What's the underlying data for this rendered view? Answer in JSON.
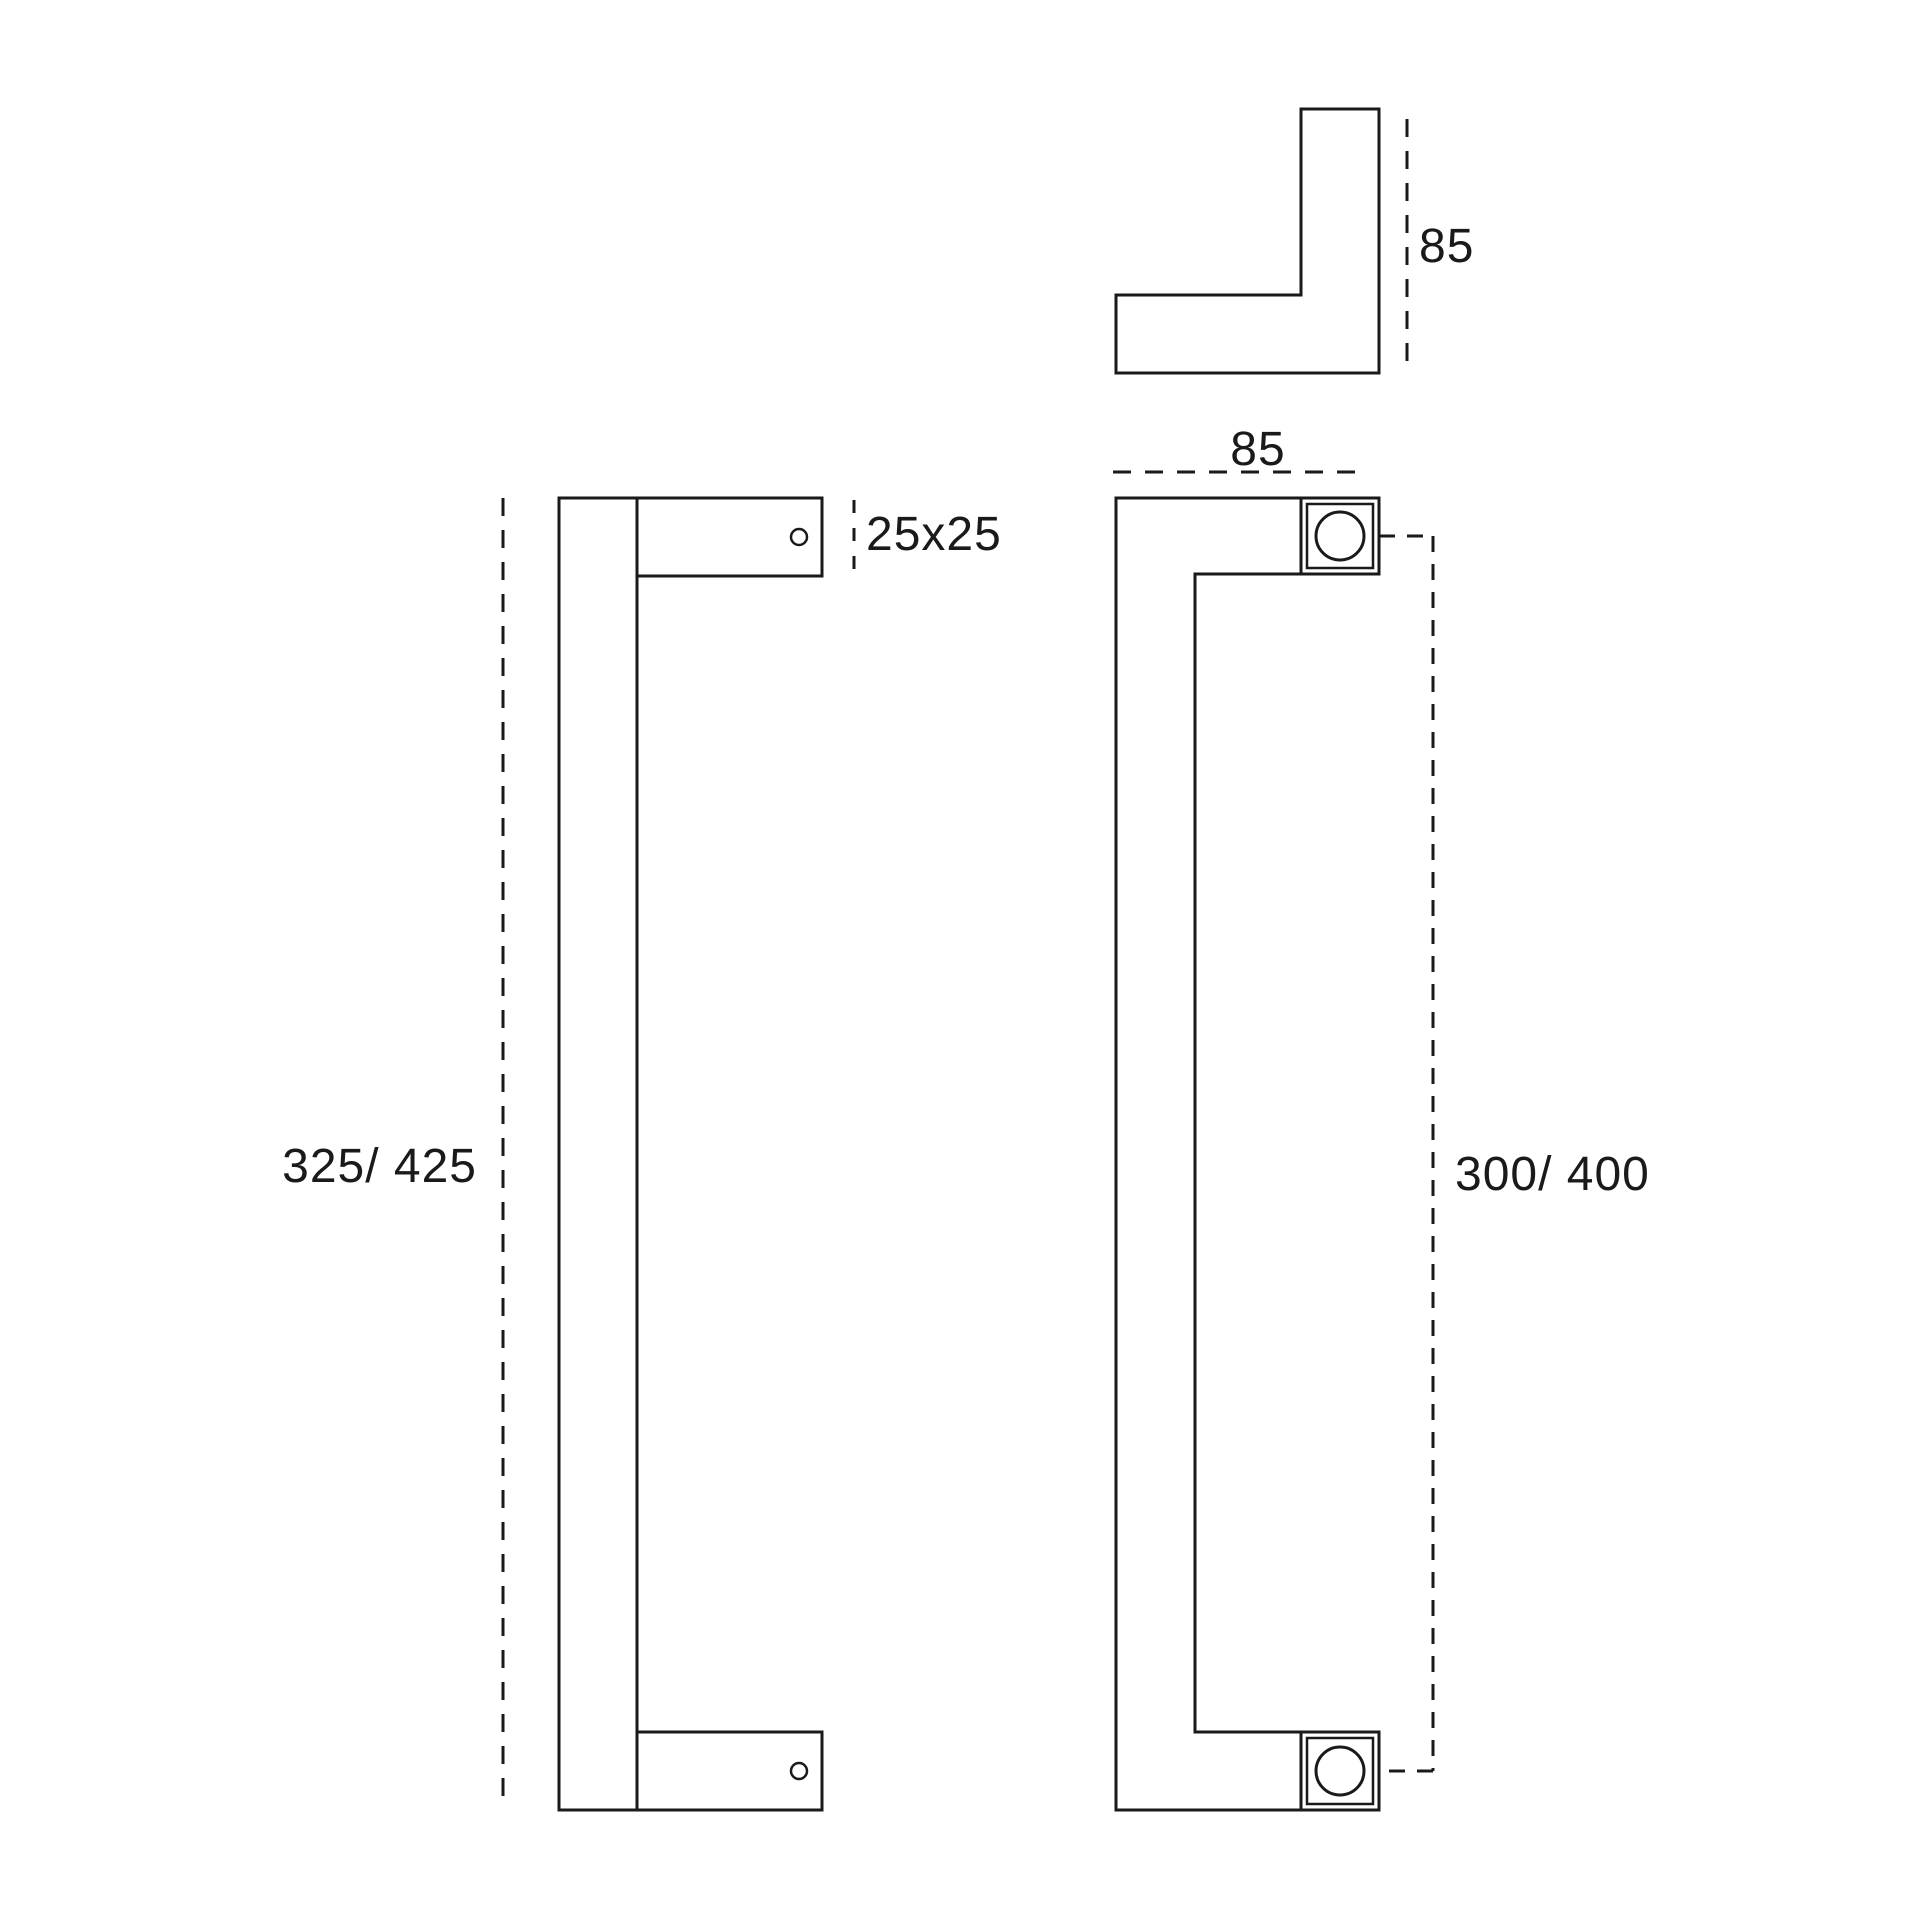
{
  "drawing": {
    "subject": "pull-handle-dimensional-drawing",
    "colors": {
      "background": "#ffffff",
      "line": "#1a1a1a",
      "text": "#1a1a1a"
    },
    "views": {
      "top_profile": {
        "depth_label": "85"
      },
      "side": {
        "length_label": "325/ 425",
        "cross_section_label": "25x25"
      },
      "front": {
        "width_label": "85",
        "centers_label": "300/ 400"
      }
    }
  }
}
